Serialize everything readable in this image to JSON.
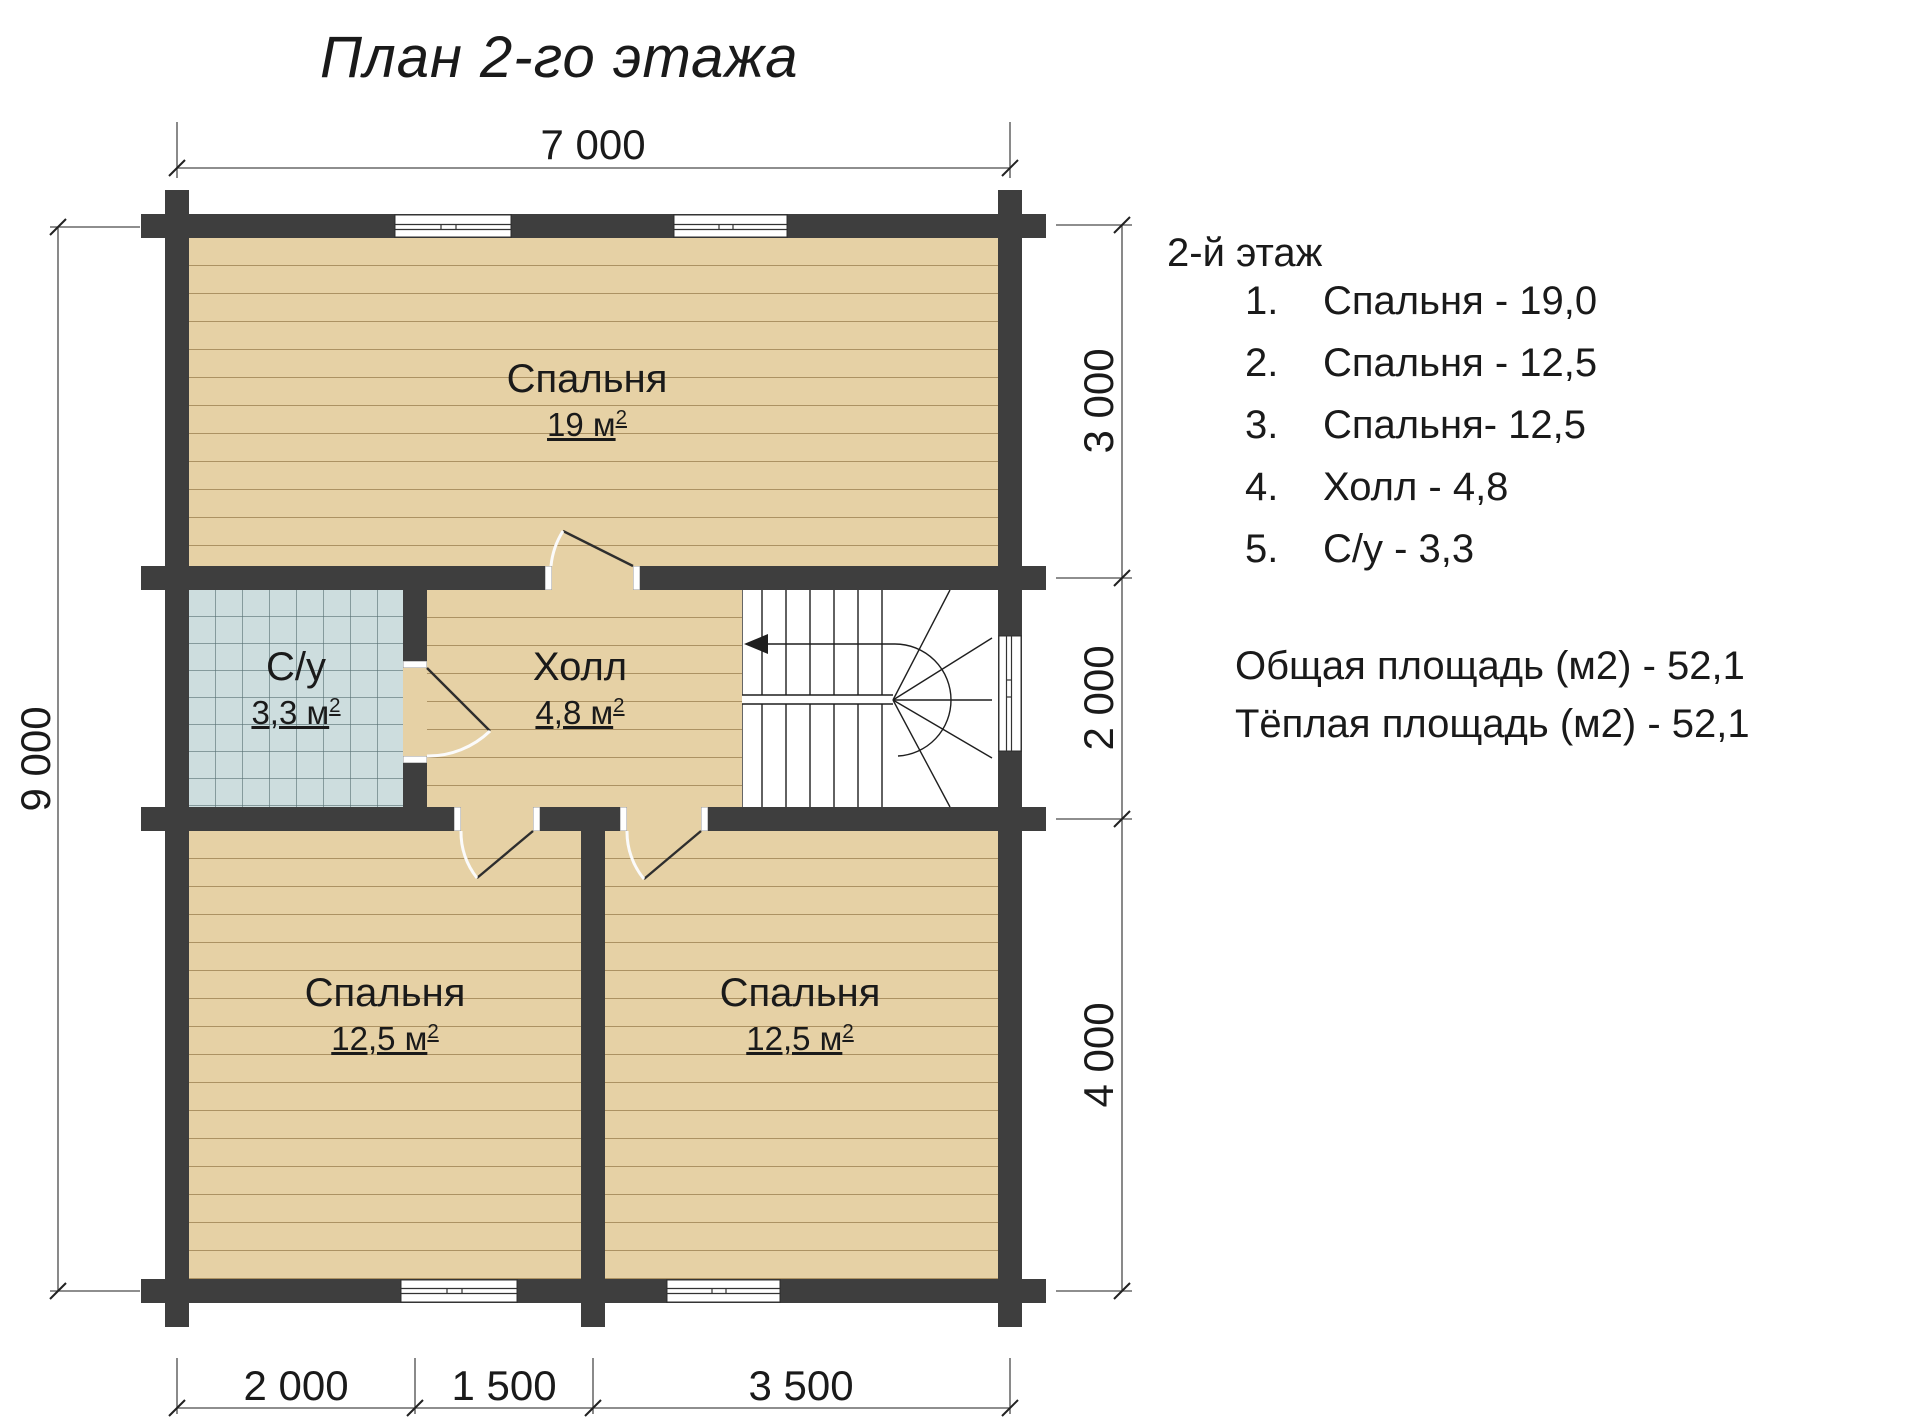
{
  "title": "План 2-го этажа",
  "plan": {
    "rooms": {
      "bedroom_top": {
        "name": "Спальня",
        "area": "19 м",
        "sup": "2"
      },
      "bathroom": {
        "name": "С/у",
        "area": "3,3 м",
        "sup": "2"
      },
      "hall": {
        "name": "Холл",
        "area": "4,8 м",
        "sup": "2"
      },
      "bedroom_bottom_left": {
        "name": "Спальня",
        "area": "12,5 м",
        "sup": "2"
      },
      "bedroom_bottom_right": {
        "name": "Спальня",
        "area": "12,5 м",
        "sup": "2"
      }
    },
    "dimensions": {
      "top": "7 000",
      "left": "9 000",
      "right": [
        "3 000",
        "2 000",
        "4 000"
      ],
      "bottom": [
        "2 000",
        "1 500",
        "3 500"
      ]
    },
    "colors": {
      "wall": "#3e3e3e",
      "wood": "#e6d1a5",
      "tile": "#cdddde"
    }
  },
  "legend": {
    "heading": "2-й этаж",
    "items": [
      {
        "num": "1.",
        "label": "Спальня - 19,0"
      },
      {
        "num": "2.",
        "label": "Спальня - 12,5"
      },
      {
        "num": "3.",
        "label": "Спальня- 12,5"
      },
      {
        "num": "4.",
        "label": "Холл - 4,8"
      },
      {
        "num": "5.",
        "label": "С/у - 3,3"
      }
    ],
    "totals": [
      "Общая площадь (м2) - 52,1",
      "Тёплая площадь  (м2) - 52,1"
    ]
  }
}
